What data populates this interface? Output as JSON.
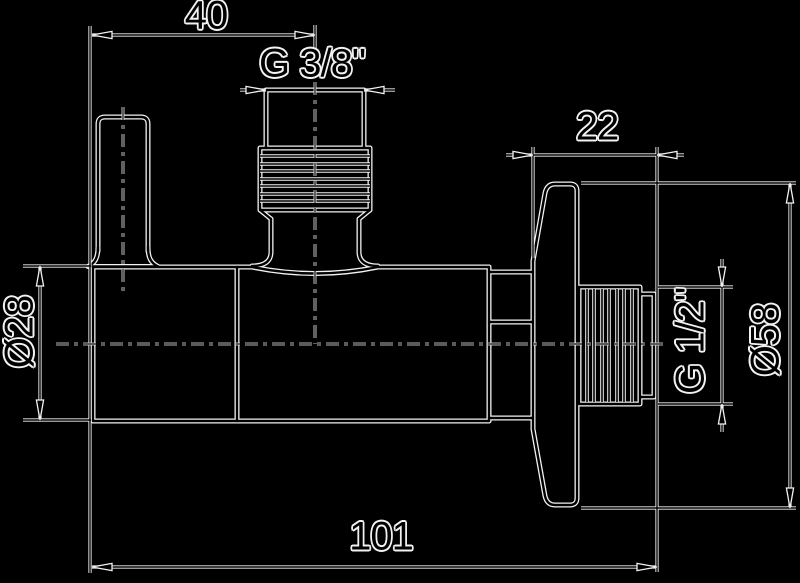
{
  "drawing": {
    "title": "Angle valve side view technical drawing",
    "background_color": "#000000",
    "line_color": "#f2f2f2",
    "labels": {
      "width_40": "40",
      "inlet_thread": "G 3/8\"",
      "depth_22": "22",
      "body_diameter": "Ø28",
      "outlet_thread": "G 1/2\"",
      "flange_diameter": "Ø58",
      "total_length": "101"
    }
  }
}
